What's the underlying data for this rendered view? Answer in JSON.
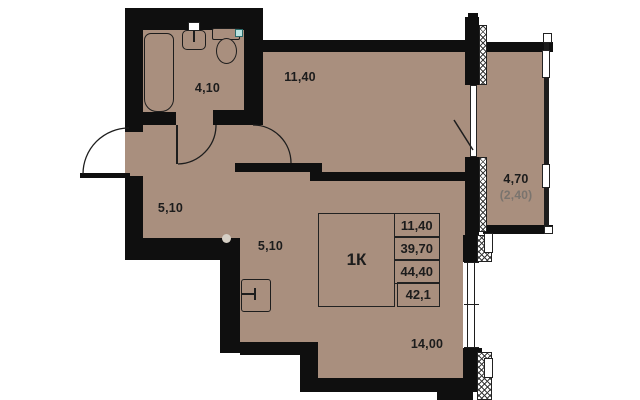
{
  "unit": {
    "type_label": "1К",
    "rows": [
      "11,40",
      "39,70",
      "44,40",
      "42,1"
    ]
  },
  "rooms": {
    "bathroom": {
      "area": "4,10"
    },
    "hall": {
      "area": "5,10"
    },
    "kitchen_corridor": {
      "area": "5,10"
    },
    "room_top": {
      "area": "11,40"
    },
    "living": {
      "area": "14,00"
    },
    "balcony": {
      "area": "4,70",
      "area_reduced": "(2,40)"
    }
  },
  "colors": {
    "floor": "#a98f7e",
    "wall": "#0f0f0f",
    "vent_marker": "#b9e3e0",
    "muted_text": "#7a746e"
  }
}
